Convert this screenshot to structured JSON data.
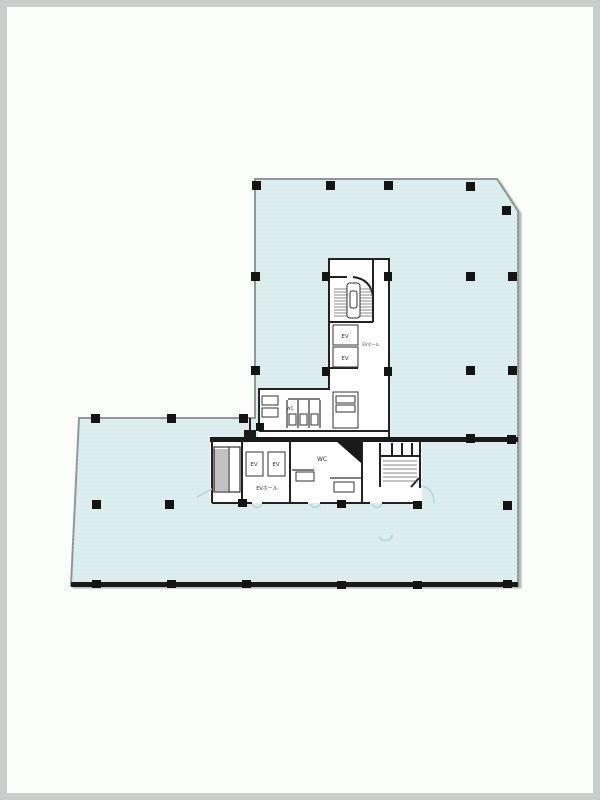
{
  "page": {
    "frame_color": "#c9cdcc",
    "background": "#fbfdfa"
  },
  "plan": {
    "colors": {
      "floor_fill": "#dcedf0",
      "floor_dot": "#c6dfe4",
      "outline": "#8f9898",
      "wall": "#222222",
      "column": "#141414",
      "detail_blue": "#aed6dc",
      "room_fill": "#ffffff"
    },
    "labels": {
      "ev": "EV",
      "ev_hall": "EVホール",
      "wc": "WC"
    },
    "columns": [
      [
        252,
        181,
        9,
        9
      ],
      [
        326,
        181,
        9,
        9
      ],
      [
        384,
        181,
        9,
        9
      ],
      [
        466,
        182,
        9,
        9
      ],
      [
        502,
        206,
        9,
        9
      ],
      [
        251,
        272,
        9,
        9
      ],
      [
        251,
        366,
        9,
        9
      ],
      [
        466,
        272,
        9,
        9
      ],
      [
        466,
        366,
        9,
        9
      ],
      [
        508,
        272,
        9,
        9
      ],
      [
        508,
        366,
        9,
        9
      ],
      [
        322,
        272,
        8,
        9
      ],
      [
        384,
        272,
        8,
        9
      ],
      [
        322,
        367,
        8,
        9
      ],
      [
        384,
        367,
        8,
        9
      ],
      [
        256,
        423,
        8,
        8
      ],
      [
        466,
        434,
        9,
        9
      ],
      [
        507,
        435,
        9,
        9
      ],
      [
        91,
        414,
        9,
        9
      ],
      [
        167,
        414,
        9,
        9
      ],
      [
        239,
        414,
        9,
        9
      ],
      [
        92,
        500,
        9,
        9
      ],
      [
        165,
        500,
        9,
        9
      ],
      [
        503,
        501,
        9,
        9
      ],
      [
        238,
        499,
        9,
        8
      ],
      [
        337,
        500,
        9,
        8
      ],
      [
        413,
        501,
        9,
        8
      ],
      [
        92,
        580,
        9,
        8
      ],
      [
        167,
        580,
        9,
        8
      ],
      [
        242,
        580,
        9,
        8
      ],
      [
        337,
        581,
        9,
        8
      ],
      [
        413,
        581,
        9,
        8
      ],
      [
        503,
        580,
        9,
        8
      ]
    ]
  }
}
